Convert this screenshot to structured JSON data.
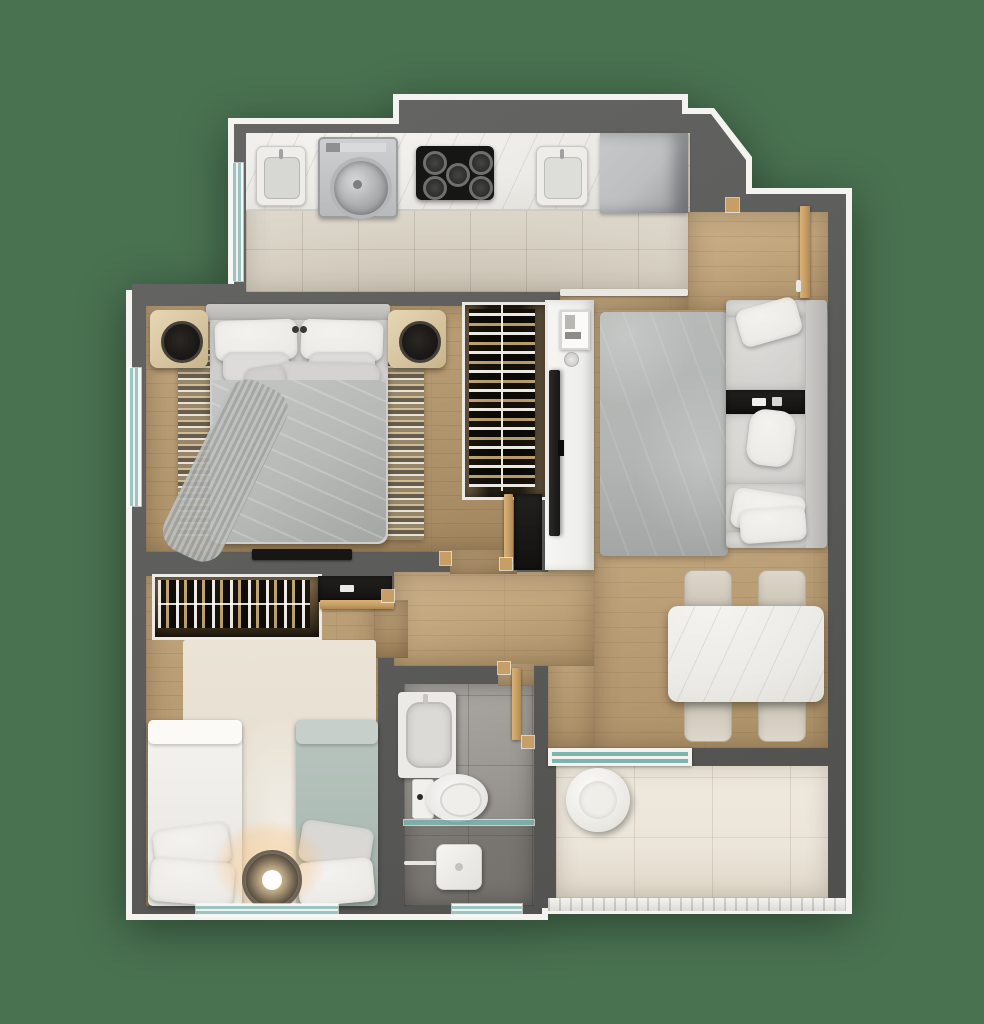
{
  "scene": {
    "type": "3d-rendered-apartment-floor-plan-top-view",
    "background_color": "#497251",
    "rooms": [
      {
        "name": "kitchen",
        "floor": "beige-ceramic-tile",
        "features": [
          "marble-counter",
          "laundry-sink",
          "top-load-washing-machine",
          "cooktop-5-burners",
          "kitchen-sink",
          "refrigerator-cabinet",
          "side-window",
          "open-passage-to-living"
        ]
      },
      {
        "name": "living-dining-room",
        "floor": "light-oak-wood",
        "features": [
          "three-seat-sofa",
          "built-in-side-console",
          "gray-area-rug",
          "white-tv-panel",
          "wall-mounted-tv",
          "marble-dining-table",
          "four-dining-chairs",
          "entry-door"
        ]
      },
      {
        "name": "master-bedroom",
        "floor": "light-oak-wood",
        "features": [
          "double-bed",
          "two-nightstands-with-plants",
          "patterned-area-rug",
          "wardrobe-with-hanging-clothes",
          "wall-tv",
          "side-window",
          "door"
        ]
      },
      {
        "name": "second-bedroom",
        "floor": "light-oak-wood",
        "features": [
          "single-bed-white",
          "single-bed-teal",
          "glowing-floor-lamp",
          "light-rug",
          "closet-with-hanging-clothes",
          "dark-shelf",
          "bottom-window",
          "door"
        ]
      },
      {
        "name": "bathroom",
        "floor": "gray-tile",
        "features": [
          "vanity-sink",
          "toilet",
          "walk-in-shower",
          "glass-partition",
          "rain-shower-head",
          "bottom-window",
          "door"
        ]
      },
      {
        "name": "balcony",
        "floor": "cream-tile",
        "features": [
          "round-white-pouf",
          "sliding-glass-door",
          "railing"
        ]
      }
    ],
    "counts": {
      "bedrooms": 2,
      "bathrooms": 1,
      "balconies": 1
    },
    "palette": {
      "bg": "#497251",
      "trim": "#f4f3f0",
      "wall": "#5d5d5b",
      "wood": "#c1a67e",
      "tile-kitchen": "#d9d3c6",
      "tile-balcony": "#ece6da",
      "tile-bath": "#97948f",
      "marble": "#eceae6",
      "appliance": "#bcbec0",
      "black": "#161614",
      "rug-living": "#b2b5b3",
      "rug-kids": "#e6dfd1",
      "sofa": "#d2d1ce",
      "pillow": "#eceae6",
      "duvet": "#b7b9b7",
      "kids-teal": "#aebcb6",
      "glass": "#7fb3ae",
      "window": "#9cc4c0",
      "door-wood": "#c79f66",
      "glow": "#ffd9a0"
    }
  }
}
